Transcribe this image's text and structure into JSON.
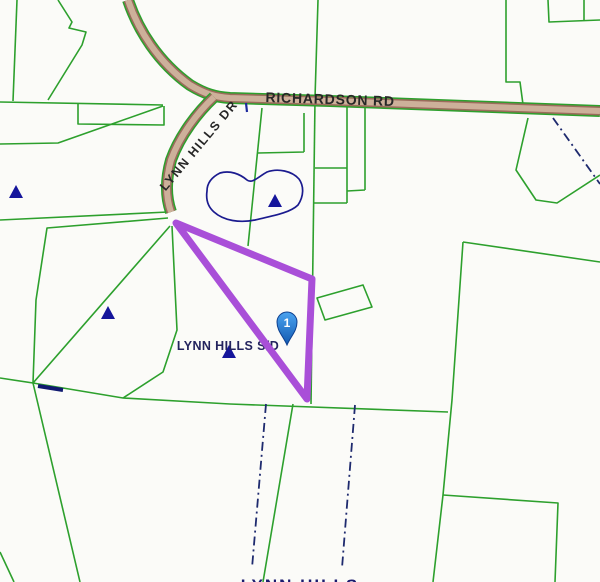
{
  "map": {
    "labels": {
      "road_main": "RICHARDSON RD",
      "road_side": "LYNN HILLS DR",
      "subdivision": "LYNN HILLS S/D",
      "bottom_partial": "LYNN HILLS"
    },
    "marker": {
      "number": "1"
    },
    "colors": {
      "parcel_line_green": "#2da02d",
      "selected_parcel_purple": "#a94fd8",
      "water_and_annotation_navy": "#1b1b8f",
      "road_fill_tan": "#cdb09a",
      "road_edge_brown": "#9b6b5c",
      "label_dark": "#272727",
      "background": "#fbfbf8",
      "pin_blue": "#1565c0"
    },
    "legend_semantics": {
      "green_lines": "parcel boundaries",
      "purple_outline": "selected parcel",
      "dash_dot_navy": "easement / boundary lines",
      "navy_triangles": "survey point markers",
      "navy_blob": "pond outline"
    }
  }
}
